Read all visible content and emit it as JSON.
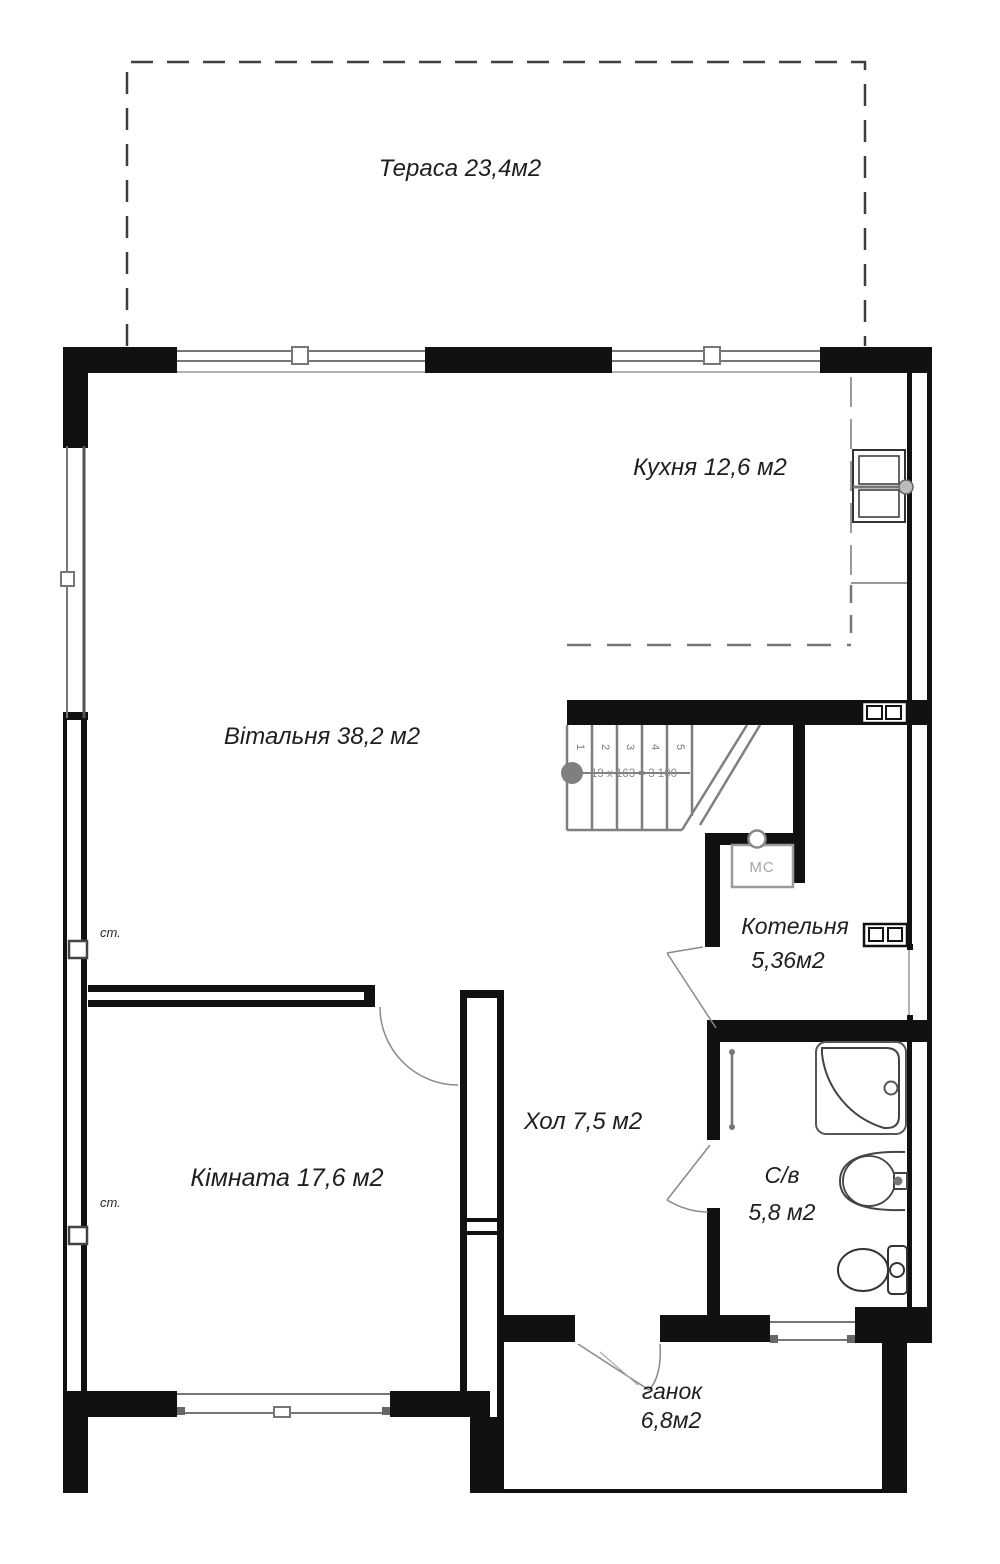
{
  "plan": {
    "rooms": {
      "terrace": {
        "label": "Тераса 23,4м2"
      },
      "kitchen": {
        "label": "Кухня 12,6 м2"
      },
      "living": {
        "label": "Вітальня 38,2 м2"
      },
      "boiler": {
        "name": "Котельня",
        "area": "5,36м2"
      },
      "hall": {
        "label": "Хол 7,5 м2"
      },
      "room": {
        "label": "Кімната 17,6 м2"
      },
      "bathroom": {
        "name": "С/в",
        "area": "5,8 м2"
      },
      "porch": {
        "name": "ганок",
        "area": "6,8м2"
      }
    },
    "stairs": {
      "steps": [
        "1",
        "2",
        "3",
        "4",
        "5"
      ],
      "formula": "19 x 163 = 3 100"
    },
    "labels": {
      "wall_marker": "ст.",
      "boiler_unit": "МС"
    },
    "colors": {
      "wall": "#111111",
      "stair_gray": "#7f7f7f",
      "label_text": "#1f1f1f",
      "muted_gray": "#8a8a8a"
    }
  }
}
